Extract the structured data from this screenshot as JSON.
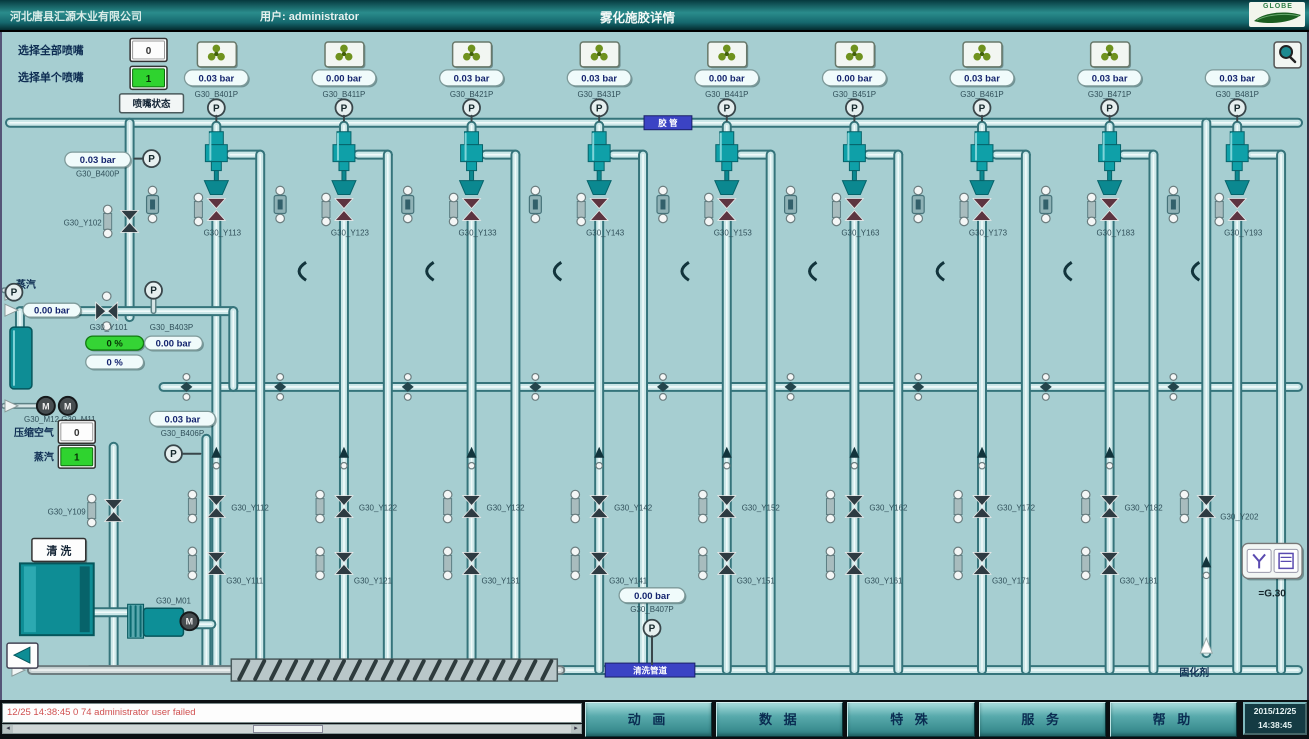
{
  "header": {
    "company": "河北唐县汇源木业有限公司",
    "user": "用户: administrator",
    "title": "雾化施胶详情",
    "logo_text": "GLOBE"
  },
  "controls": {
    "select_all_label": "选择全部喷嘴",
    "select_all_value": "0",
    "select_single_label": "选择单个喷嘴",
    "select_single_value": "1",
    "nozzle_status_button": "喷嘴状态"
  },
  "diagram": {
    "pipe_labels": {
      "top": "胶 管",
      "bottom": "清洗管道"
    },
    "columns": [
      {
        "fan": true,
        "pressure": "0.03 bar",
        "tag": "G30_B401P",
        "nozzle_valve": "G30_Y113",
        "mid_valve": "G30_Y112",
        "bottom_valve": "G30_Y111"
      },
      {
        "fan": true,
        "pressure": "0.00 bar",
        "tag": "G30_B411P",
        "nozzle_valve": "G30_Y123",
        "mid_valve": "G30_Y122",
        "bottom_valve": "G30_Y121"
      },
      {
        "fan": true,
        "pressure": "0.03 bar",
        "tag": "G30_B421P",
        "nozzle_valve": "G30_Y133",
        "mid_valve": "G30_Y132",
        "bottom_valve": "G30_Y131"
      },
      {
        "fan": true,
        "pressure": "0.03 bar",
        "tag": "G30_B431P",
        "nozzle_valve": "G30_Y143",
        "mid_valve": "G30_Y142",
        "bottom_valve": "G30_Y141"
      },
      {
        "fan": true,
        "pressure": "0.00 bar",
        "tag": "G30_B441P",
        "nozzle_valve": "G30_Y153",
        "mid_valve": "G30_Y152",
        "bottom_valve": "G30_Y151"
      },
      {
        "fan": true,
        "pressure": "0.00 bar",
        "tag": "G30_B451P",
        "nozzle_valve": "G30_Y163",
        "mid_valve": "G30_Y162",
        "bottom_valve": "G30_Y161"
      },
      {
        "fan": true,
        "pressure": "0.03 bar",
        "tag": "G30_B461P",
        "nozzle_valve": "G30_Y173",
        "mid_valve": "G30_Y172",
        "bottom_valve": "G30_Y171"
      },
      {
        "fan": true,
        "pressure": "0.03 bar",
        "tag": "G30_B471P",
        "nozzle_valve": "G30_Y183",
        "mid_valve": "G30_Y182",
        "bottom_valve": "G30_Y181"
      },
      {
        "fan": false,
        "pressure": "0.03 bar",
        "tag": "G30_B481P",
        "nozzle_valve": "G30_Y193",
        "mid_valve": null,
        "bottom_valve": null
      }
    ],
    "left": {
      "steam_top_label": "蒸汽",
      "top_display": {
        "value": "0.03 bar",
        "tag": "G30_B400P"
      },
      "valve_y102": "G30_Y102",
      "steam_pressure": "0.00 bar",
      "mixer": {
        "valve_tag": "G30_Y101",
        "sensor_tag": "G30_B403P",
        "flow_green": "0 %",
        "pressure": "0.00 bar",
        "flow_white": "0 %"
      },
      "motors_tag": "G30_M12 G30_M11",
      "air": {
        "label": "压缩空气",
        "value": "0"
      },
      "steam": {
        "label": "蒸汽",
        "value": "1"
      },
      "valve_y109": "G30_Y109",
      "wash_button": "清 洗",
      "pump_tag": "G30_M01",
      "air_display": {
        "value": "0.03 bar",
        "tag": "G30_B406P"
      }
    },
    "center_bottom": {
      "value": "0.00 bar",
      "tag": "G30_B407P"
    },
    "right": {
      "valve_tag": "G30_Y202",
      "panel_label": "=G.30",
      "product_label": "固化剂"
    }
  },
  "bottom_bar": {
    "alarm_text": "12/25 14:38:45 0 74    administrator    user failed",
    "buttons": [
      "动 画",
      "数 据",
      "特 殊",
      "服 务",
      "帮 助"
    ],
    "datetime_date": "2015/12/25",
    "datetime_time": "14:38:45"
  }
}
